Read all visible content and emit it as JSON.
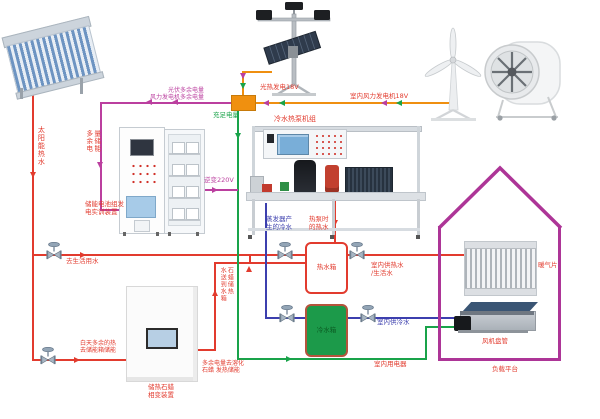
{
  "palette": {
    "hot_water_red": "#e23b2e",
    "cold_water_blue": "#3c3fae",
    "electric_green": "#19a34a",
    "generation_orange": "#ef8f10",
    "surplus_magenta": "#bb3f9f",
    "house_purple": "#ad3597",
    "cold_tank_green": "#1c9a4a"
  },
  "labels": {
    "solar_hot_water": "太阳能热水",
    "pv_surplus": "光伏多余电量",
    "wind_surplus": "风力发电机多余电量",
    "pv_generation": "光热发电18V",
    "indoor_wind_generation": "室内风力发电机18V",
    "sufficient_power": "充足电量",
    "inverter": "逆变220V",
    "surplus_store_col1": "多余电",
    "surplus_store_col2": "量储能",
    "battery_cabinet_l1": "储能电池组发",
    "battery_cabinet_l2": "电实训装置",
    "heat_pump_title": "冷水热泵机组",
    "evaporator_l1": "蒸发器产",
    "evaporator_l2": "生的冷水",
    "condenser_l1": "热泵时",
    "condenser_l2": "的热水",
    "domestic_water": "去生活用水",
    "day_surplus_l1": "白天多余的热",
    "day_surplus_l2": "去储能箱储能",
    "paraffin_device_l1": "储热石蜡",
    "paraffin_device_l2": "相变装置",
    "melt_l1": "多余电量去溶化",
    "melt_l2": "石蜡 发热储能",
    "paraffin_to_tank_col1": "水送到水箱",
    "paraffin_to_tank_col2": "石蜡储热",
    "hot_tank": "热水箱",
    "cold_tank": "冷水箱",
    "supply_hot_l1": "室内供热水",
    "supply_hot_l2": "/生活水",
    "supply_cold": "室内供冷水",
    "indoor_appliance": "室内用电器",
    "radiator": "暖气片",
    "fan_coil": "风机盘管",
    "load_platform": "负载平台"
  }
}
